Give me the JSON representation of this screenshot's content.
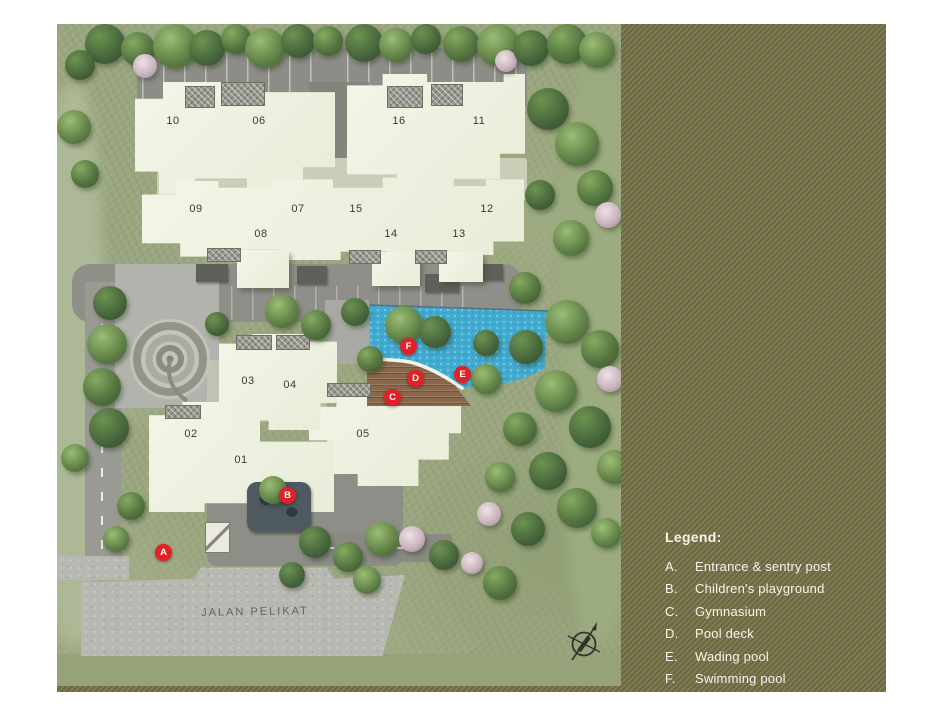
{
  "site_plan": {
    "road_label": "JALAN PELIKAT",
    "building_labels": {
      "b01": "01",
      "b02": "02",
      "b03": "03",
      "b04": "04",
      "b05": "05",
      "b06": "06",
      "b07": "07",
      "b08": "08",
      "b09": "09",
      "b10": "10",
      "b11": "11",
      "b12": "12",
      "b13": "13",
      "b14": "14",
      "b15": "15",
      "b16": "16"
    },
    "markers": {
      "a": "A",
      "b": "B",
      "c": "C",
      "d": "D",
      "e": "E",
      "f": "F"
    },
    "icons": {
      "compass": "compass-rose"
    }
  },
  "legend": {
    "title": "Legend:",
    "items": [
      {
        "key": "A.",
        "label": "Entrance & sentry post"
      },
      {
        "key": "B.",
        "label": "Children's playground"
      },
      {
        "key": "C.",
        "label": "Gymnasium"
      },
      {
        "key": "D.",
        "label": "Pool deck"
      },
      {
        "key": "E.",
        "label": "Wading pool"
      },
      {
        "key": "F.",
        "label": "Swimming pool"
      }
    ]
  },
  "colors": {
    "panel_olive_light": "#807b52",
    "panel_olive_dark": "#6b6742",
    "marker_red": "#e32026",
    "pool_blue": "#43abd0",
    "building_cream": "#eef0df",
    "legend_text": "#f6f5ec"
  }
}
